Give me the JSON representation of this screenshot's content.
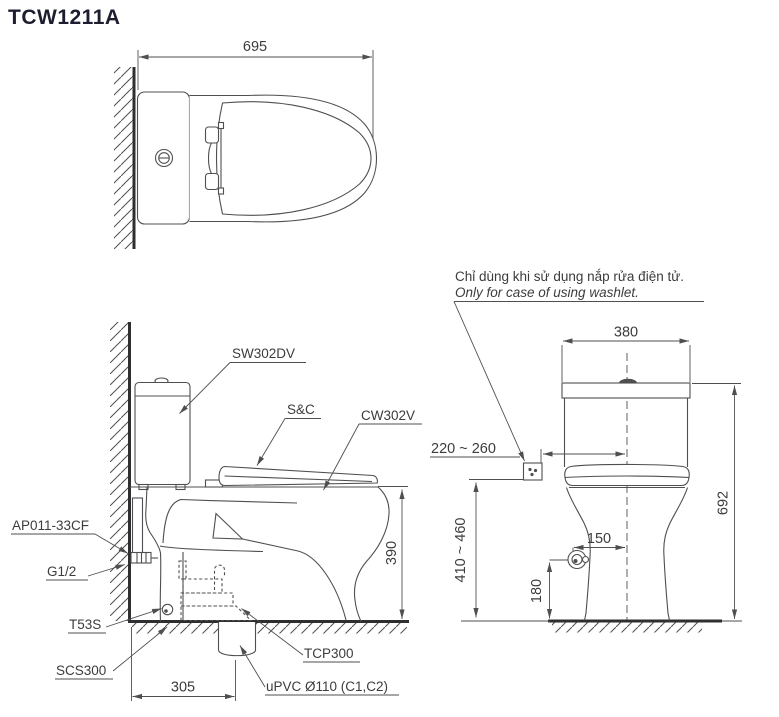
{
  "title": "TCW1211A",
  "note": {
    "line1_vi": "Chỉ dùng khi sử dụng nắp rửa điện tử.",
    "line2_en": "Only for case of using washlet."
  },
  "colors": {
    "line": "#4f4f51",
    "thick_line": "#2f2f31",
    "text": "#3c3c3e",
    "title_text": "#1d1d30",
    "background": "#ffffff"
  },
  "views": {
    "top": {
      "dims": {
        "overall_depth": "695"
      }
    },
    "side": {
      "labels": {
        "tank": "SW302DV",
        "seat_cover": "S&C",
        "bowl": "CW302V",
        "angle_valve": "AP011-33CF",
        "supply_thread": "G1/2",
        "hose": "T53S",
        "floor_flange": "SCS300",
        "outlet_socket": "TCP300",
        "drain_pipe": "uPVC Ø110 (C1,C2)"
      },
      "dims": {
        "rim_height": "390",
        "outlet_from_wall": "305"
      }
    },
    "front": {
      "dims": {
        "tank_width": "380",
        "overall_height": "692",
        "outlet_side_range": "220 ~ 260",
        "outlet_height_range": "410 ~ 460",
        "supply_from_center": "150",
        "supply_height": "180"
      }
    }
  }
}
